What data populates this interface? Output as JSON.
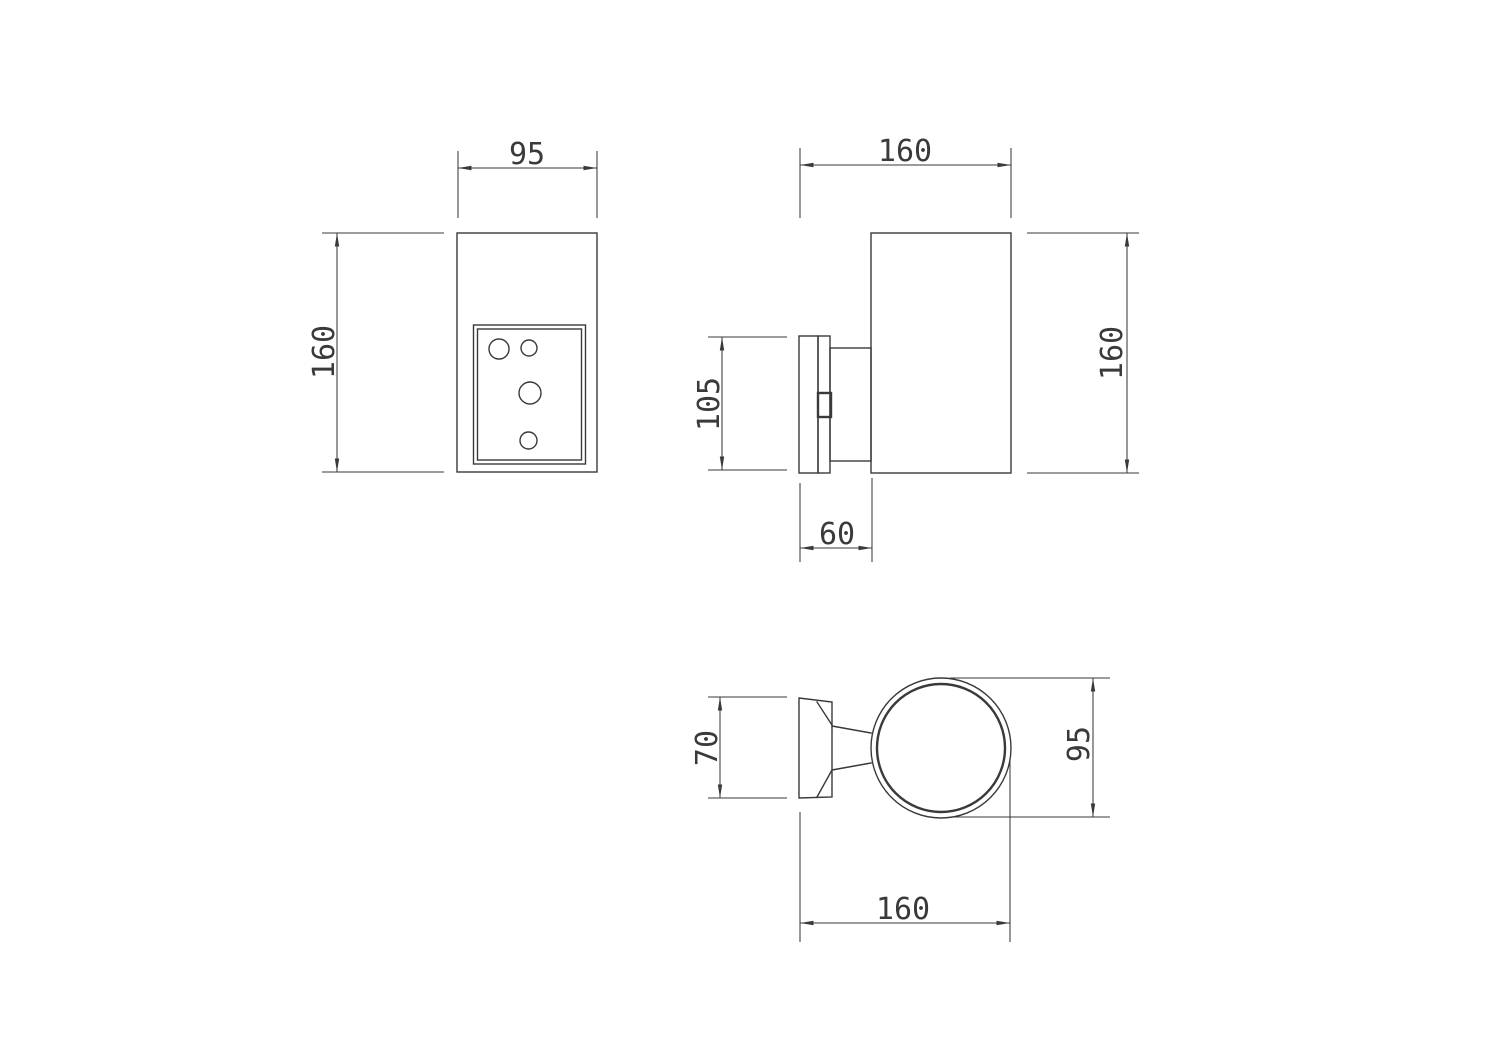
{
  "colors": {
    "line": "#3a3a3a",
    "background": "#ffffff"
  },
  "views": {
    "front": {
      "width": "95",
      "height": "160"
    },
    "side": {
      "width": "160",
      "height": "160",
      "backplate_height": "105",
      "mount_depth": "60"
    },
    "top": {
      "backplate_width": "70",
      "body_diameter": "95",
      "depth": "160"
    }
  }
}
